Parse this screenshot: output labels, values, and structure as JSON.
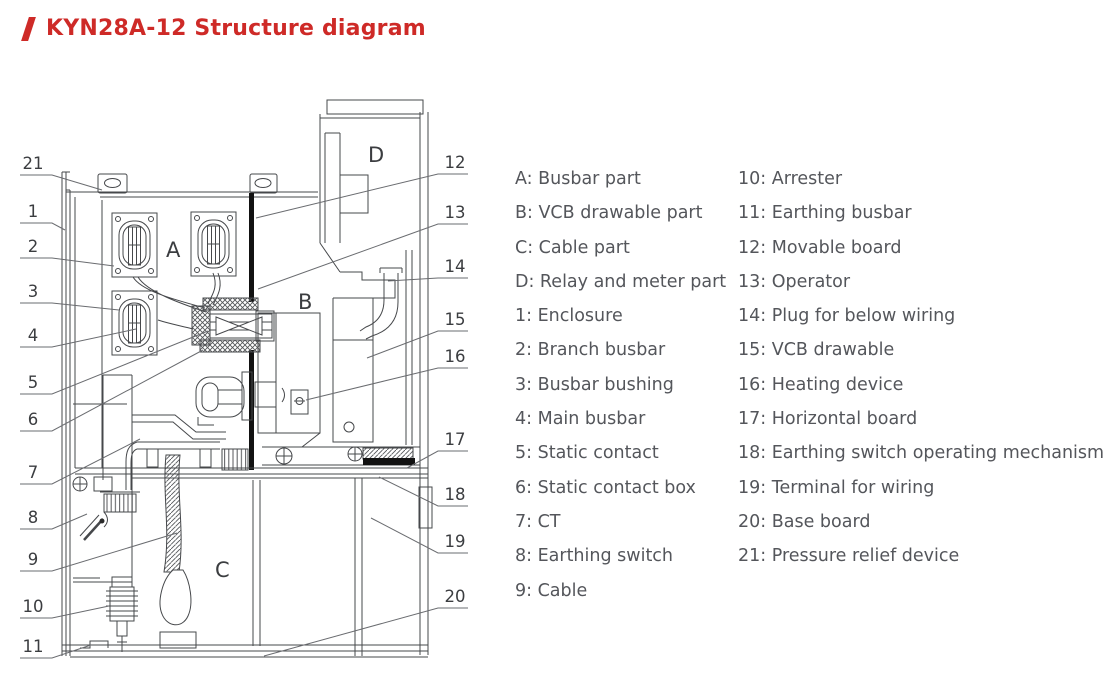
{
  "title": "KYN28A-12 Structure diagram",
  "legend": {
    "left": [
      "A: Busbar part",
      "B: VCB drawable part",
      "C: Cable part",
      "D: Relay and meter part",
      "1: Enclosure",
      "2: Branch busbar",
      "3: Busbar bushing",
      "4: Main busbar",
      "5: Static contact",
      "6: Static contact box",
      "7: CT",
      "8: Earthing switch",
      "9: Cable"
    ],
    "right": [
      "10: Arrester",
      "11: Earthing busbar",
      "12: Movable board",
      "13: Operator",
      "14: Plug for below wiring",
      "15: VCB drawable",
      "16: Heating device",
      "17: Horizontal board",
      "18: Earthing switch operating mechanism",
      "19: Terminal for wiring",
      "20: Base board",
      "21: Pressure relief device"
    ]
  },
  "diagram": {
    "compartments": [
      "A",
      "B",
      "C",
      "D"
    ],
    "callouts_left": [
      "21",
      "1",
      "2",
      "3",
      "4",
      "5",
      "6",
      "7",
      "8",
      "9",
      "10",
      "11"
    ],
    "callouts_right": [
      "12",
      "13",
      "14",
      "15",
      "16",
      "17",
      "18",
      "19",
      "20"
    ]
  },
  "colors": {
    "accent_red": "#ce2a27",
    "line": "#46484b",
    "legend_text": "#54565b"
  }
}
